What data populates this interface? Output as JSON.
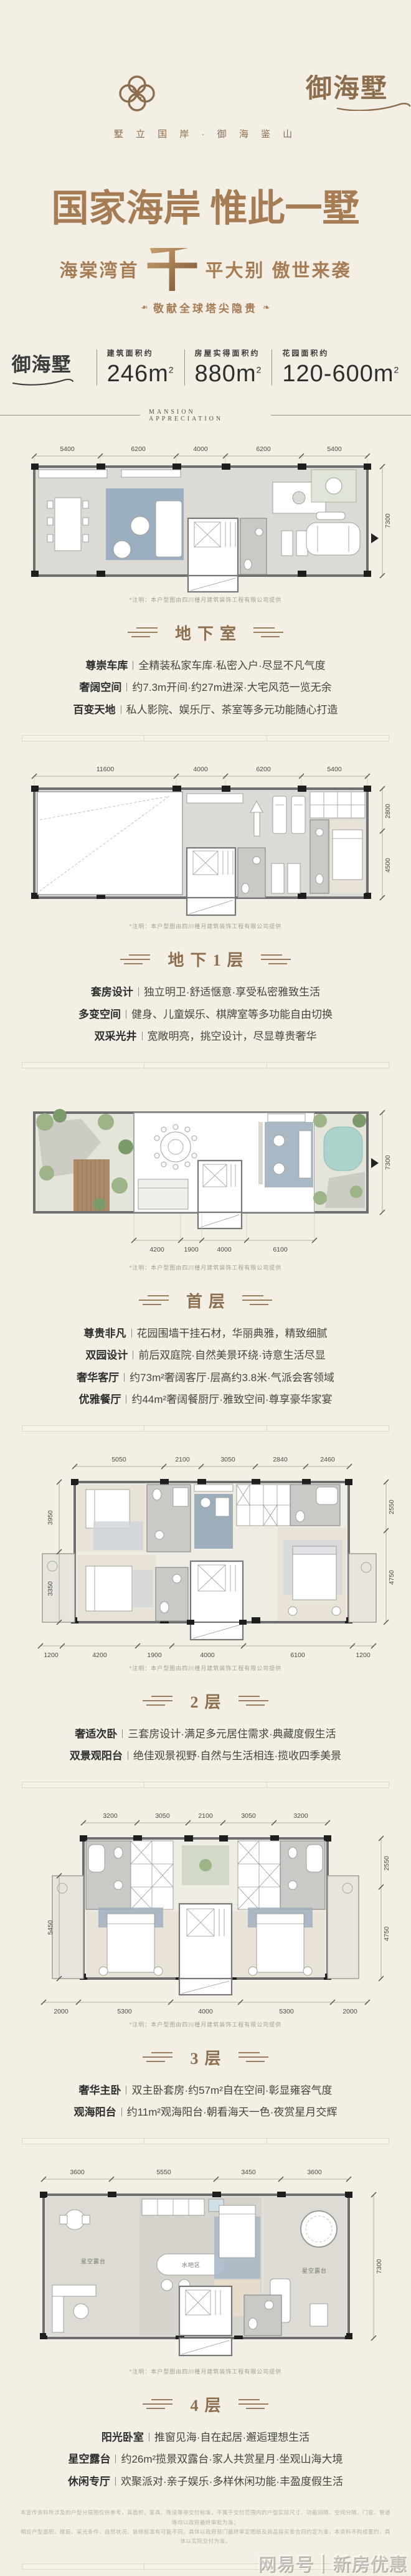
{
  "colors": {
    "bg": "#f4efe5",
    "accent": "#a57c54",
    "brand": "#8c6d4d",
    "dark": "#2e2e2e"
  },
  "header": {
    "logo": "御海墅",
    "tagline": "墅 立 国 岸 · 御 海 鉴 山"
  },
  "hero": {
    "title": "国家海岸 惟此一墅",
    "sub_left": "海棠湾首",
    "sub_big": "千",
    "sub_right": "平大别 傲世来袭",
    "ribbon": "敬献全球塔尖隐贵",
    "leaf": "❧"
  },
  "stats": {
    "logo": "御海墅",
    "items": [
      {
        "label": "建筑面积约",
        "num": "246",
        "unit": "m",
        "sup": "2"
      },
      {
        "label": "房屋实得面积约",
        "num": "880",
        "unit": "m",
        "sup": "2"
      },
      {
        "label": "花园面积约",
        "num": "120-600",
        "unit": "m",
        "sup": "2"
      }
    ]
  },
  "divider_label": "MANSION APPRECIATION",
  "note": "*注明：本户型图由四川槿月建筑装饰工程有限公司提供",
  "plans": {
    "b2": {
      "title": "地下室",
      "dims_top": [
        "5400",
        "6200",
        "4000",
        "6200",
        "5400"
      ],
      "dims_right": [
        "7300"
      ],
      "features": [
        {
          "label": "尊崇车库",
          "desc": "全精装私家车库·私密入户·尽显不凡气度"
        },
        {
          "label": "奢阔空间",
          "desc": "约7.3m开间·约27m进深·大宅风范一览无余"
        },
        {
          "label": "百变天地",
          "desc": "私人影院、娱乐厅、茶室等多元功能随心打造"
        }
      ]
    },
    "b1": {
      "title": "地下1层",
      "dims_top": [
        "11600",
        "4000",
        "6200",
        "5400"
      ],
      "dims_right": [
        "2800",
        "4500"
      ],
      "features": [
        {
          "label": "套房设计",
          "desc": "独立明卫·舒适惬意·享受私密雅致生活"
        },
        {
          "label": "多变空间",
          "desc": "健身、儿童娱乐、棋牌室等多功能自由切换"
        },
        {
          "label": "双采光井",
          "desc": "宽敞明亮，挑空设计，尽显尊贵奢华"
        }
      ]
    },
    "f1": {
      "title": "首层",
      "dims_bottom": [
        "4200",
        "1900",
        "4000",
        "6100"
      ],
      "dims_right": [
        "7300"
      ],
      "features": [
        {
          "label": "尊贵非凡",
          "desc": "花园围墙干挂石材，华丽典雅，精致细腻"
        },
        {
          "label": "双园设计",
          "desc": "前后双庭院·自然美景环绕·诗意生活尽显"
        },
        {
          "label": "奢华客厅",
          "desc": "约73m²奢阔客厅·层高约3.8米·气派会客领域"
        },
        {
          "label": "优雅餐厅",
          "desc": "约44m²奢阔餐厨厅·雅致空间·尊享豪华家宴"
        }
      ]
    },
    "f2": {
      "title": "2层",
      "dims_top": [
        "5050",
        "2100",
        "3050",
        "2840",
        "2460"
      ],
      "dims_left": [
        "3950",
        "3350"
      ],
      "dims_right": [
        "2550",
        "4750"
      ],
      "dims_bottom": [
        "1200",
        "4200",
        "1900",
        "4000",
        "6100",
        "1200"
      ],
      "features": [
        {
          "label": "奢适次卧",
          "desc": "三套房设计·满足多元居住需求·典藏度假生活"
        },
        {
          "label": "双景观阳台",
          "desc": "绝佳观景视野·自然与生活相连·揽收四季美景"
        }
      ]
    },
    "f3": {
      "title": "3层",
      "dims_top": [
        "3200",
        "3050",
        "2100",
        "3050",
        "3200"
      ],
      "dims_left": [
        "5450"
      ],
      "dims_right": [
        "2550",
        "4750"
      ],
      "dims_bottom": [
        "2000",
        "5300",
        "4000",
        "5300",
        "2000"
      ],
      "features": [
        {
          "label": "奢华主卧",
          "desc": "双主卧套房·约57m²自在空间·彰显雍容气度"
        },
        {
          "label": "观海阳台",
          "desc": "约11m²观海阳台·朝看海天一色·夜赏星月交辉"
        }
      ]
    },
    "f4": {
      "title": "4层",
      "dims_top": [
        "3600",
        "5550",
        "3450",
        "3600"
      ],
      "dims_right": [
        "7300"
      ],
      "room_labels": {
        "bar": "水吧区",
        "terrace_left": "星空露台",
        "terrace_right": "星空露台"
      },
      "features": [
        {
          "label": "阳光卧室",
          "desc": "推窗见海·自在起居·邂逅理想生活"
        },
        {
          "label": "星空露台",
          "desc": "约26m²揽景双露台·家人共赏星月·坐观山海大境"
        },
        {
          "label": "休闲专厅",
          "desc": "欢聚派对·亲子娱乐·多样休闲功能·丰盈度假生活"
        }
      ]
    }
  },
  "footer": {
    "disclaimer1": "本宣传资料所涉及的户型分层图仅供参考，其面积、家具、陈设等非交付标准，不属于交付范围内的户型实际尺寸、功能间隔、空间分隔、门窗、管道等均以政府最终审批为准；",
    "disclaimer2": "相应户型面积、楼层、采光条件、自然状况、装修标准有可能不同，具体以政府部门最终审定图纸及商品房买卖合同约定为准，本资料不构成要约，具体以实际交付为准。",
    "watermark": "网易号｜新房优惠"
  }
}
